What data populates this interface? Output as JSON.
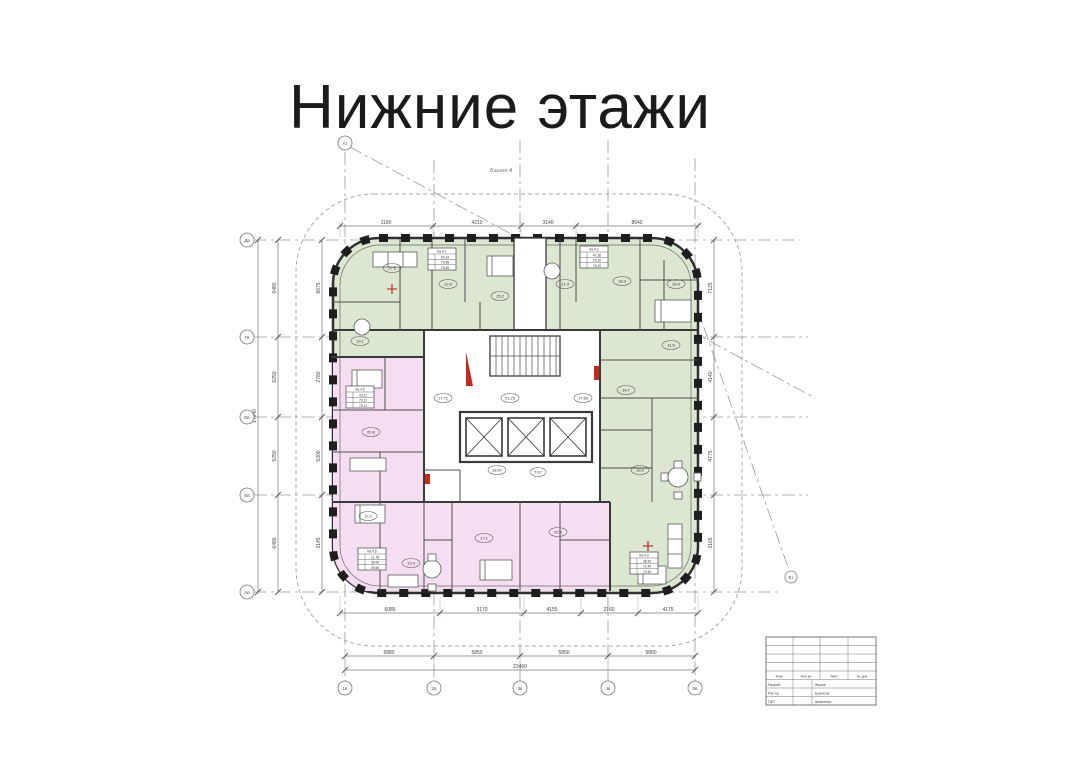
{
  "page": {
    "title": "Нижние этажи"
  },
  "plan": {
    "tower_label": "Башня А",
    "colors": {
      "apartment_green": "#dbe7d0",
      "apartment_pink": "#f6def2",
      "wall": "#2b2b2b",
      "axis_line": "#9a9a9a",
      "accent_red": "#c5281c"
    },
    "axes": {
      "left": [
        "Дв",
        "Гв",
        "Вв",
        "Бв",
        "Ав"
      ],
      "bottom": [
        "1в",
        "2в",
        "3в",
        "4в",
        "5в"
      ],
      "corner_top": "Ат",
      "corner_right": "Бт"
    },
    "dims": {
      "top": [
        "1190",
        "4210",
        "3140",
        "8640"
      ],
      "bottom_inner": [
        "6085",
        "3170",
        "4155",
        "2160",
        "4175"
      ],
      "bottom_outer": [
        "5880",
        "5850",
        "5850",
        "5880"
      ],
      "bottom_total": "23460",
      "left_outer": [
        "6480",
        "5250",
        "5250",
        "6480"
      ],
      "left_total": "17640",
      "left_inner": [
        "8675",
        "2780",
        "5300",
        "3145"
      ],
      "right_inner": [
        "7125",
        "4140",
        "4775",
        "3165"
      ]
    },
    "stamps": [
      {
        "title": "Кв.4.1",
        "rows": [
          "84.33",
          "76.85",
          "76.85"
        ]
      },
      {
        "title": "Кв.4.2",
        "rows": [
          "47.36",
          "76.20",
          "76.20"
        ]
      },
      {
        "title": "Кв.4.5",
        "rows": [
          "43.11",
          "70.11",
          "70.11"
        ]
      },
      {
        "title": "Кв.4.6",
        "rows": [
          "11.78",
          "39.56",
          "39.56"
        ]
      },
      {
        "title": "Кв.4.3",
        "rows": [
          "38.36",
          "72.40",
          "72.40"
        ]
      }
    ],
    "rooms": [
      "17.5",
      "12.8",
      "15.2",
      "21.4",
      "18.3",
      "16.4",
      "11.6",
      "14.7",
      "19.2",
      "13.1",
      "20.8",
      "12.2",
      "15.9",
      "17.1",
      "22.6"
    ],
    "core_labels": [
      "17.71",
      "21.25",
      "17.80",
      "18.67",
      "7.67"
    ],
    "title_block": {
      "header": [
        "Изм",
        "Кол.уч",
        "Лист",
        "№ док"
      ],
      "rows": [
        [
          "Разраб.",
          "Жуков"
        ],
        [
          "Рук.пр.",
          "Борисов"
        ],
        [
          "ГАП",
          "Шевченко"
        ]
      ]
    }
  }
}
